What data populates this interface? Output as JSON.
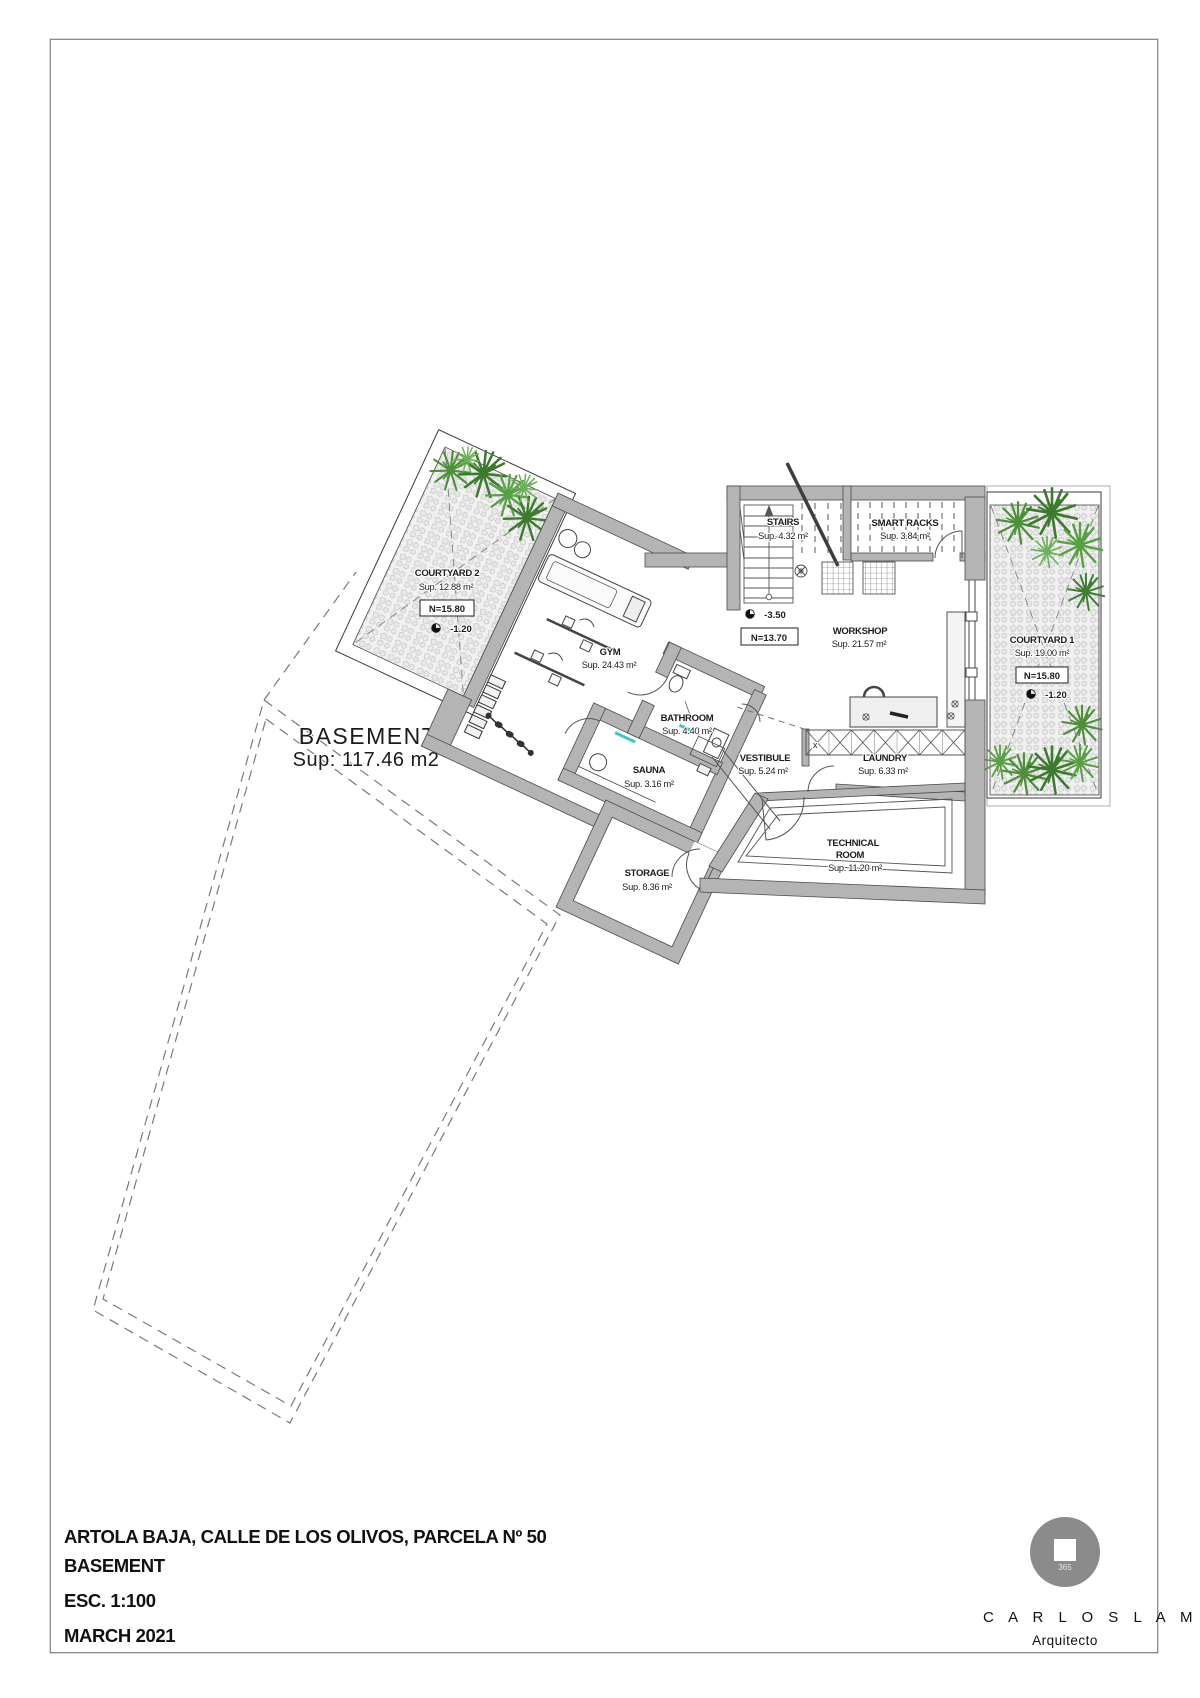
{
  "document": {
    "project_title": "ARTOLA BAJA, CALLE DE LOS OLIVOS, PARCELA Nº 50",
    "sheet_name": "BASEMENT",
    "scale": "ESC. 1:100",
    "date": "MARCH  2021"
  },
  "architect": {
    "logo_number": "365",
    "name": "C A R L O S  L A M A S",
    "title": "Arquitecto"
  },
  "plan": {
    "floor_label": "BASEMENT",
    "floor_area": "Sup: 117.46 m2",
    "rooms": {
      "courtyard2": {
        "name": "COURTYARD 2",
        "area": "Sup. 12.88 m²",
        "level": "N=15.80",
        "depth": "-1.20"
      },
      "gym": {
        "name": "GYM",
        "area": "Sup. 24.43 m²"
      },
      "bathroom": {
        "name": "BATHROOM",
        "area": "Sup. 4.40 m²"
      },
      "sauna": {
        "name": "SAUNA",
        "area": "Sup. 3.16 m²"
      },
      "storage": {
        "name": "STORAGE",
        "area": "Sup. 8.36 m²"
      },
      "vestibule": {
        "name": "VESTIBULE",
        "area": "Sup. 5.24 m²"
      },
      "laundry": {
        "name": "LAUNDRY",
        "area": "Sup. 6.33 m²"
      },
      "workshop": {
        "name": "WORKSHOP",
        "area": "Sup. 21.57 m²"
      },
      "stairs": {
        "name": "STAIRS",
        "area": "Sup. 4.32 m²"
      },
      "smart_racks": {
        "name": "SMART RACKS",
        "area": "Sup. 3.84 m²"
      },
      "technical": {
        "name_line1": "TECHNICAL",
        "name_line2": "ROOM",
        "area": "Sup. 11.20 m²"
      },
      "courtyard1": {
        "name": "COURTYARD 1",
        "area": "Sup. 19.00 m²",
        "level": "N=15.80",
        "depth": "-1.20"
      }
    },
    "level_marks": {
      "depth": "-3.50",
      "level": "N=13.70"
    },
    "symbols": {
      "laundry_rack_cell": "x"
    },
    "colors": {
      "wall": "#b4b4b4",
      "plant_green": "#4e8f3b",
      "glass_teal": "#3fc6c9",
      "pebble_bg": "#f1f1f1"
    }
  }
}
